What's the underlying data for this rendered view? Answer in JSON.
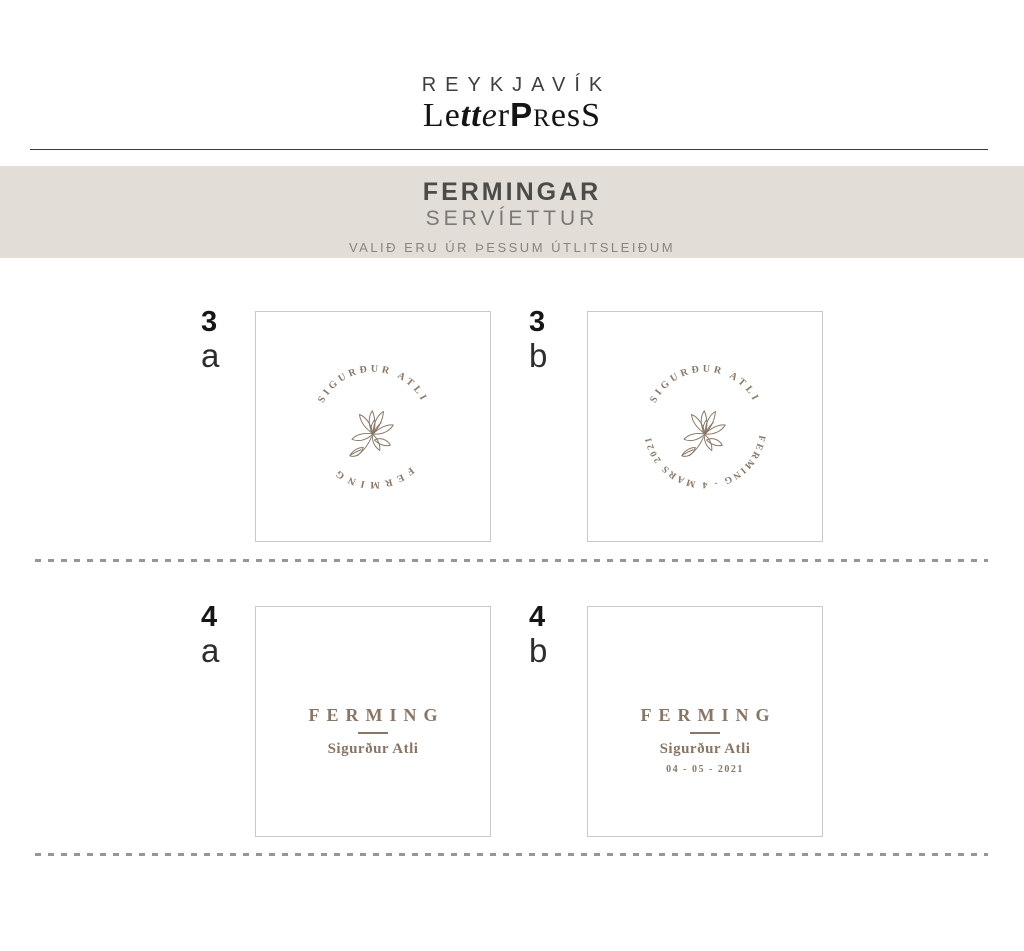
{
  "logo": {
    "line1": "REYKJAVÍK",
    "line2": {
      "p1": "L",
      "p2": "e",
      "p3": "tt",
      "p4": "e",
      "p5": "r",
      "p6": "P",
      "p7": "R",
      "p8": "es",
      "p9": "S"
    }
  },
  "banner": {
    "title": "FERMINGAR",
    "subtitle": "SERVÍETTUR",
    "note": "VALIÐ ERU ÚR ÞESSUM ÚTLITSLEIÐUM",
    "bg_color": "#e2ded7"
  },
  "colors": {
    "accent_brown": "#877666",
    "banner_background": "#e2ded7",
    "card_border": "#c9c9c9",
    "dash_gray": "#969696",
    "text_dark": "#161616"
  },
  "designs": {
    "d3a": {
      "number": "3",
      "letter": "a",
      "arc_top": "SIGURÐUR ATLI",
      "arc_bottom": "FERMING",
      "motif": "magnolia-flower-line-art"
    },
    "d3b": {
      "number": "3",
      "letter": "b",
      "arc_top": "SIGURÐUR ATLI",
      "arc_bottom": "FERMING - 4 MARS 2021",
      "motif": "magnolia-flower-line-art"
    },
    "d4a": {
      "number": "4",
      "letter": "a",
      "title": "FERMING",
      "name": "Sigurður Atli"
    },
    "d4b": {
      "number": "4",
      "letter": "b",
      "title": "FERMING",
      "name": "Sigurður Atli",
      "date": "04 - 05 - 2021"
    }
  }
}
